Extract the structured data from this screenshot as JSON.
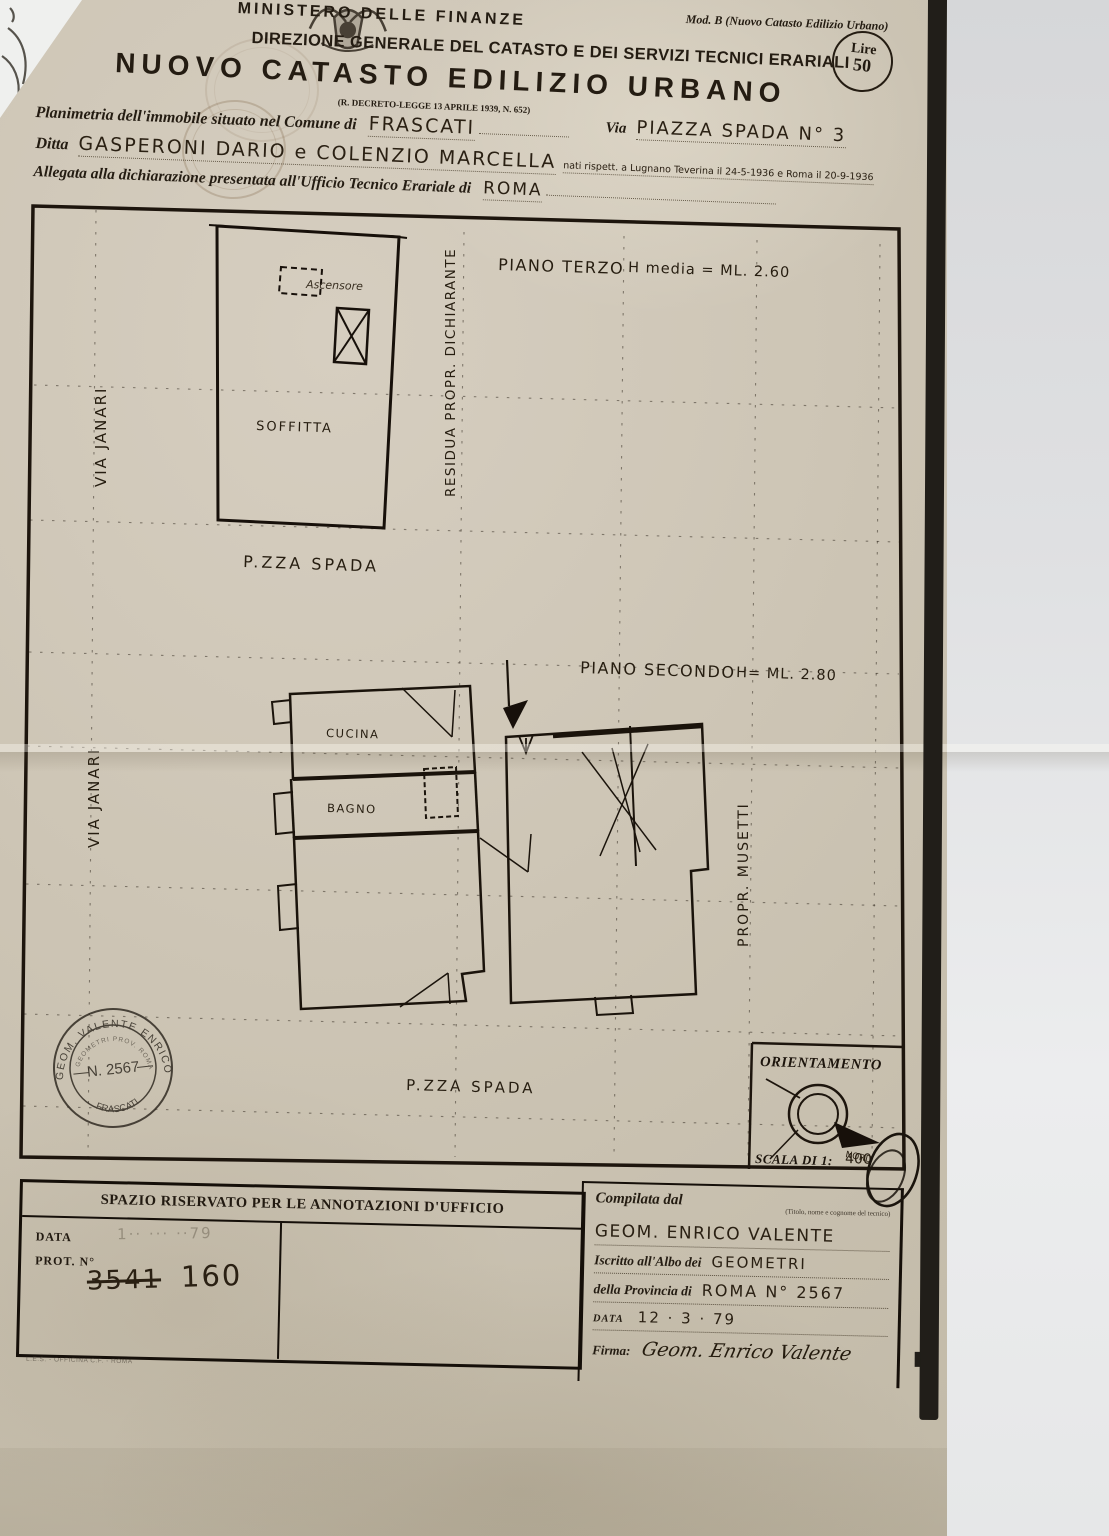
{
  "colors": {
    "paper": "#cdc5b5",
    "ink": "#221a11",
    "handwriting": "#2a2013",
    "background_paper": "#e6e7e8",
    "shadow_band": "#211e19"
  },
  "header": {
    "mod_line": "Mod. B (Nuovo Catasto Edilizio Urbano)",
    "ministry": "MINISTERO DELLE FINANZE",
    "direction": "DIREZIONE GENERALE DEL CATASTO E DEI SERVIZI TECNICI ERARIALI",
    "title": "NUOVO CATASTO EDILIZIO URBANO",
    "decree": "(R. DECRETO-LEGGE 13 APRILE 1939, N. 652)",
    "duty_line1": "Lire",
    "duty_line2": "50"
  },
  "form": {
    "comune_label": "Planimetria dell'immobile situato nel Comune di",
    "comune_value": "FRASCATI",
    "via_label": "Via",
    "via_value": "PIAZZA SPADA N° 3",
    "ditta_label": "Ditta",
    "ditta_value": "GASPERONI DARIO e COLENZIO MARCELLA",
    "ditta_note": "nati rispett. a Lugnano Teverina il 24-5-1936 e Roma il 20-9-1936",
    "allegata_label": "Allegata alla dichiarazione presentata all'Ufficio Tecnico Erariale di",
    "allegata_value": "ROMA"
  },
  "plan": {
    "floor3_label": "PIANO TERZO",
    "floor3_height": "H media = ML. 2.60",
    "floor2_label": "PIANO SECONDO",
    "floor2_height": "H= ML. 2.80",
    "via_janari_top": "VIA JANARI",
    "via_janari_bottom": "VIA JANARI",
    "pzza_spada_top": "P.ZZA SPADA",
    "pzza_spada_bottom": "P.ZZA SPADA",
    "residua": "RESIDUA PROPR. DICHIARANTE",
    "propr_musetti": "PROPR. MUSETTI",
    "soffitta": "SOFFITTA",
    "ascensore": "Ascensore",
    "cucina": "CUCINA",
    "bagno": "BAGNO"
  },
  "stamp": {
    "arc_top": "GEOM.  VALENTE  ENRICO",
    "inner_arc": "GEOMETRI  PROV.  ROMA",
    "number": "N. 2567",
    "arc_bottom": "FRASCATI"
  },
  "orientation": {
    "title": "ORIENTAMENTO",
    "north_label": "NORD",
    "scale_label": "SCALA DI 1:",
    "scale_value": "400"
  },
  "office_box": {
    "title": "SPAZIO RISERVATO PER LE ANNOTAZIONI D'UFFICIO",
    "data_label": "DATA",
    "prot_label": "PROT. N°",
    "faint_stamp": "1·· ··· ··79",
    "prot_crossed": "3541",
    "prot_value": "160",
    "printer_mark": "L.E.S. - OFFICINA C.F. - ROMA"
  },
  "compiler": {
    "title": "Compilata dal",
    "hint": "(Titolo, nome e cognome del tecnico)",
    "name": "GEOM. ENRICO VALENTE",
    "albo_label": "Iscritto all'Albo dei",
    "albo_value": "GEOMETRI",
    "prov_label": "della Provincia di",
    "prov_value": "ROMA N° 2567",
    "date_label": "DATA",
    "date_value": "12 · 3 · 79",
    "firma_label": "Firma:",
    "firma_value": "Geom. Enrico Valente"
  }
}
